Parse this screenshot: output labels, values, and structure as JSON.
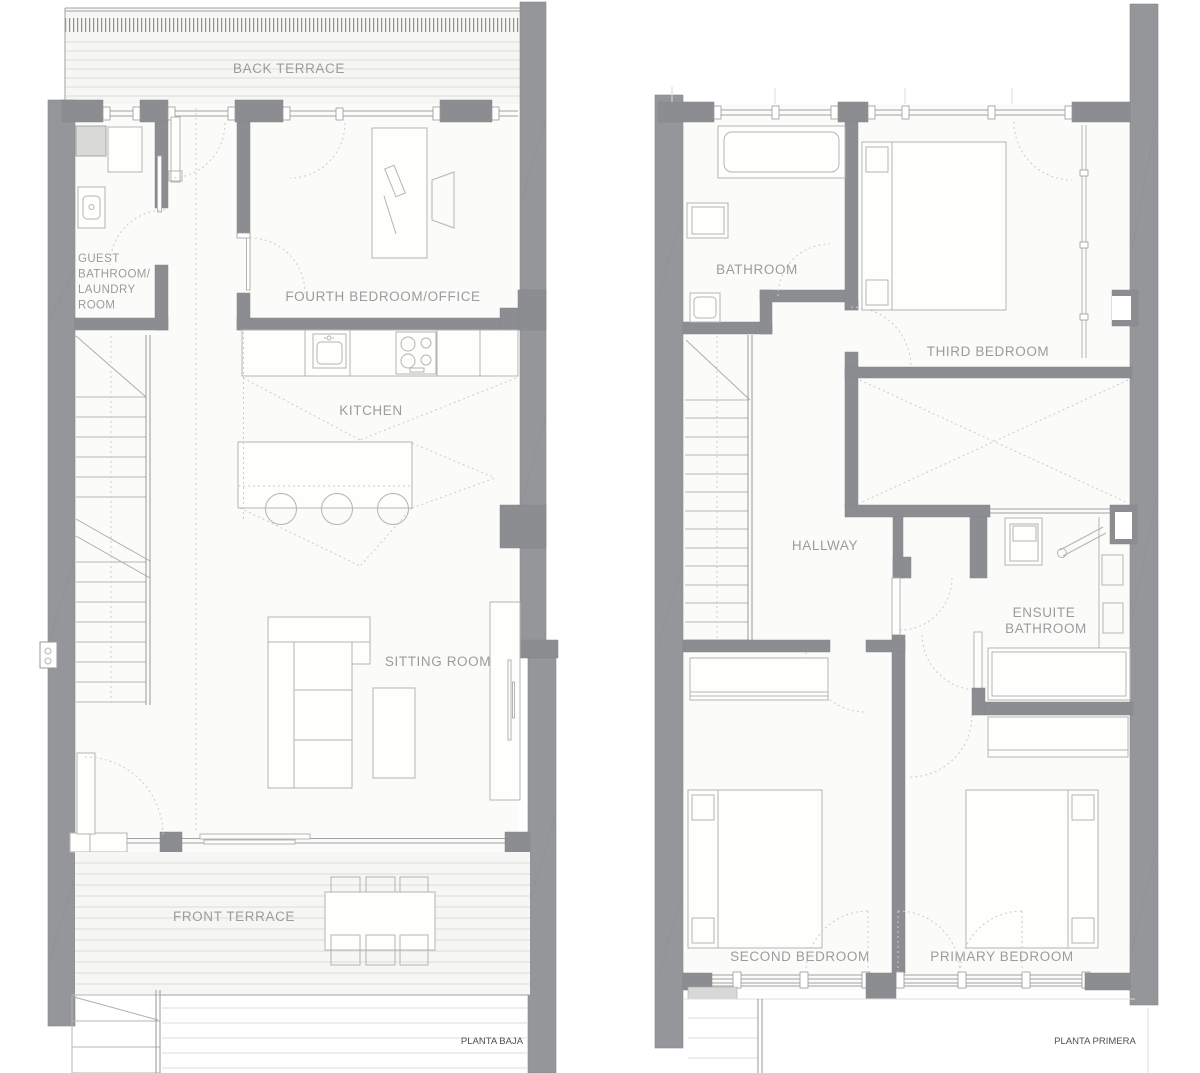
{
  "floorplans": {
    "ground": {
      "title": "PLANTA BAJA",
      "rooms": {
        "back_terrace": "BACK TERRACE",
        "guest_bath_lines": [
          "GUEST",
          "BATHROOM/",
          "LAUNDRY",
          "ROOM"
        ],
        "fourth_bedroom": "FOURTH BEDROOM/OFFICE",
        "kitchen": "KITCHEN",
        "sitting_room": "SITTING ROOM",
        "front_terrace": "FRONT TERRACE"
      }
    },
    "first": {
      "title": "PLANTA PRIMERA",
      "rooms": {
        "bathroom": "BATHROOM",
        "third_bedroom": "THIRD BEDROOM",
        "hallway": "HALLWAY",
        "ensuite_lines": [
          "ENSUITE",
          "BATHROOM"
        ],
        "second_bedroom": "SECOND BEDROOM",
        "primary_bedroom": "PRIMARY BEDROOM"
      }
    }
  },
  "colors": {
    "party_wall": "#949699",
    "pier": "#8b8d90",
    "interior_wall": "#98989a",
    "label_text": "#9c9c9c",
    "title_text": "#4f4f4f",
    "furniture_line": "#b4b4b2",
    "deck_line": "#dcdcda",
    "dotted_line": "#cccccc",
    "floor": "#fbfbfa",
    "terrace": "#f6f6f4"
  }
}
